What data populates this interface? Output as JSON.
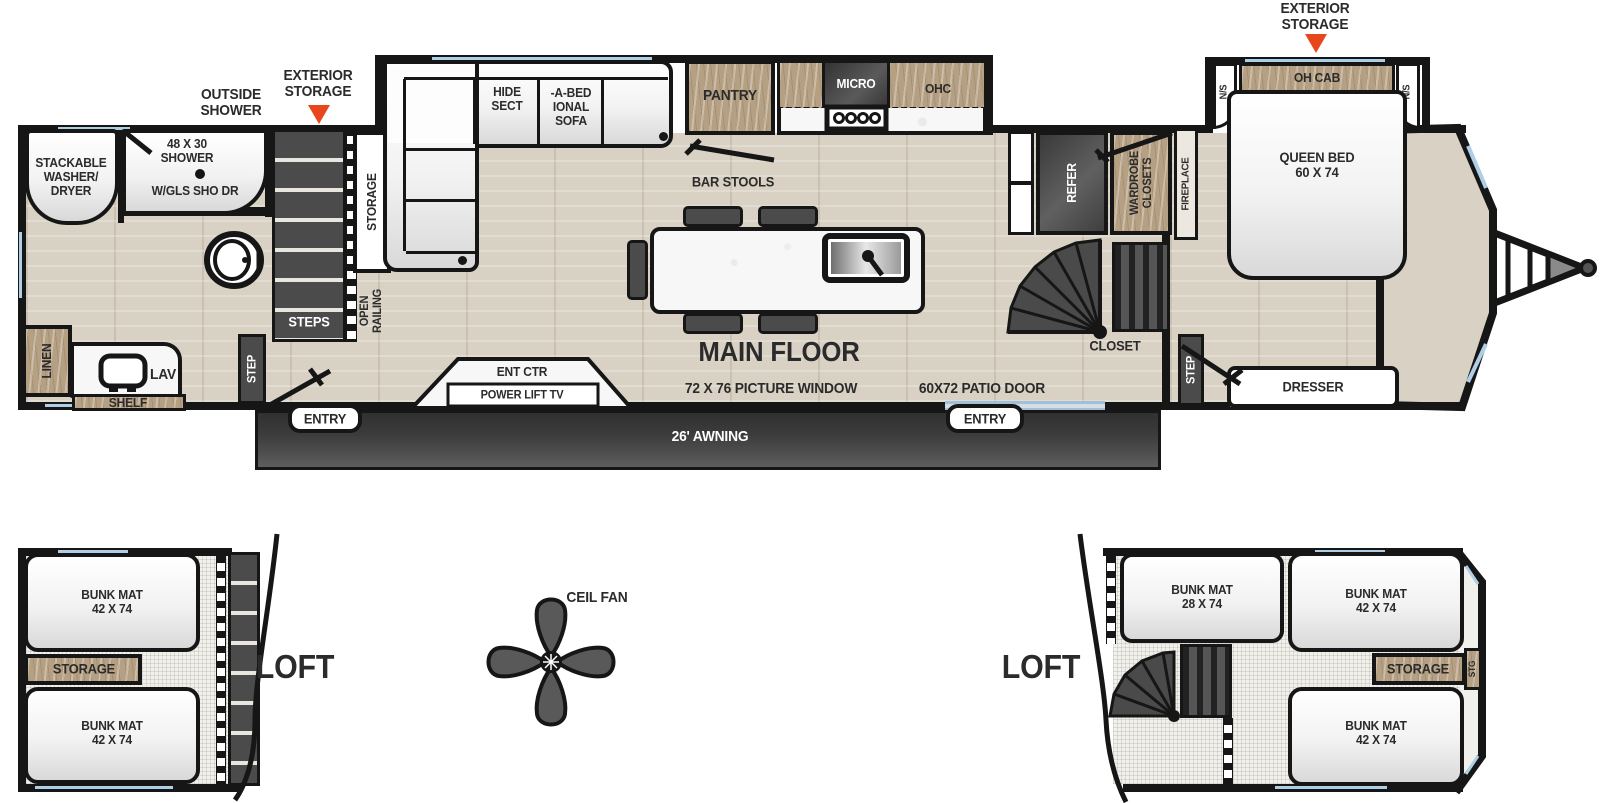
{
  "colors": {
    "wall": "#161616",
    "floor_wood": "#d9d2c4",
    "cabinet_wood": "#b6a083",
    "dark_fixture": "#4b4b4b",
    "accent_red": "#e8471e",
    "window_blue": "#aecfe6",
    "text": "#2b2b2b",
    "awning_dark": "#3a3a3a"
  },
  "labels": {
    "outside_shower": "OUTSIDE\nSHOWER",
    "exterior_storage": "EXTERIOR\nSTORAGE",
    "washer_dryer": "STACKABLE\nWASHER/\nDRYER",
    "shower_size": "48 X 30\nSHOWER",
    "shower_door": "W/GLS SHO DR",
    "linen": "LINEN",
    "lav": "LAV",
    "shelf": "SHELF",
    "step": "STEP",
    "steps": "STEPS",
    "storage": "STORAGE",
    "open_railing": "OPEN\nRAILING",
    "sofa_hide": "HIDE\nSECT",
    "sofa_abed": "-A-BED\nIONAL\nSOFA",
    "pantry": "PANTRY",
    "micro": "MICRO",
    "ohc": "OHC",
    "bar_stools": "BAR STOOLS",
    "main_floor": "MAIN FLOOR",
    "picture_window": "72 X 76 PICTURE WINDOW",
    "patio_door": "60X72 PATIO DOOR",
    "entry": "ENTRY",
    "awning": "26' AWNING",
    "ent_ctr": "ENT CTR",
    "power_lift_tv": "POWER LIFT TV",
    "refer": "REFER",
    "wardrobe_closets": "WARDROBE\nCLOSETS",
    "fireplace": "FIREPLACE",
    "closet": "CLOSET",
    "oh_cab": "OH CAB",
    "ns": "N/S",
    "queen_bed": "QUEEN BED\n60 X 74",
    "dresser": "DRESSER",
    "loft": "LOFT",
    "ceil_fan": "CEIL FAN",
    "bunk_42": "BUNK MAT\n42 X 74",
    "bunk_28": "BUNK MAT\n28 X 74",
    "stg": "STG"
  }
}
